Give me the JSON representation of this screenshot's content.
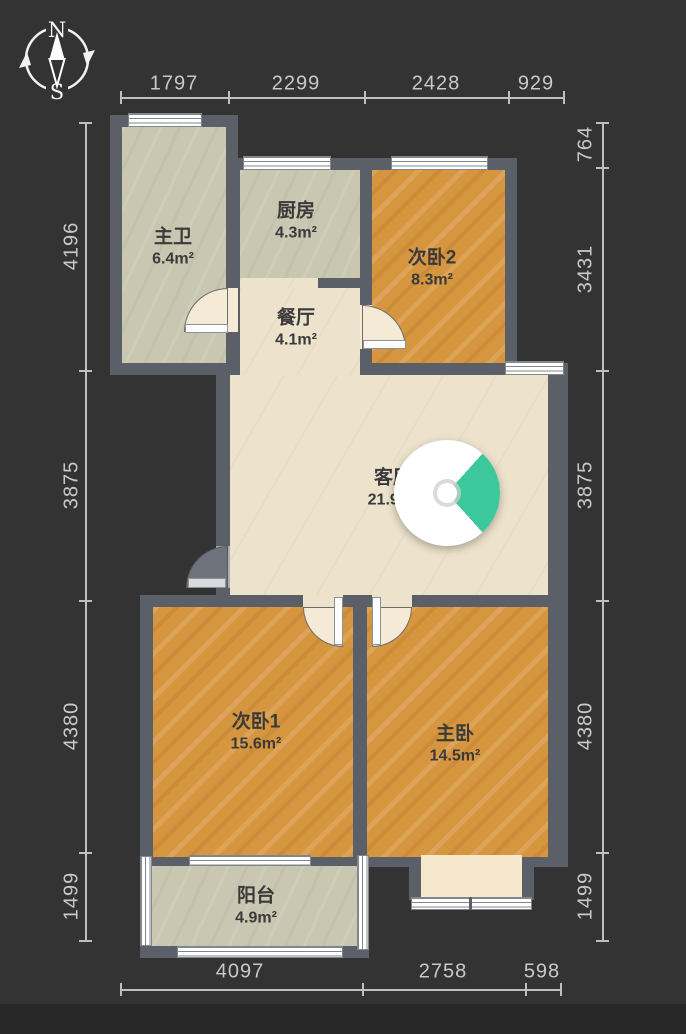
{
  "app": {
    "type": "floor-plan-viewer"
  },
  "compass": {
    "north_label": "N",
    "south_label": "S"
  },
  "rooms": [
    {
      "id": "master-bath",
      "name": "主卫",
      "area": "6.4m²"
    },
    {
      "id": "kitchen",
      "name": "厨房",
      "area": "4.3m²"
    },
    {
      "id": "dining",
      "name": "餐厅",
      "area": "4.1m²"
    },
    {
      "id": "bedroom2",
      "name": "次卧2",
      "area": "8.3m²"
    },
    {
      "id": "living",
      "name": "客厅",
      "area": "21.9m²"
    },
    {
      "id": "bedroom1",
      "name": "次卧1",
      "area": "15.6m²"
    },
    {
      "id": "master-bedroom",
      "name": "主卧",
      "area": "14.5m²"
    },
    {
      "id": "balcony",
      "name": "阳台",
      "area": "4.9m²"
    }
  ],
  "dimensions": {
    "top": [
      "1797",
      "2299",
      "2428",
      "929"
    ],
    "left": [
      "4196",
      "3875",
      "4380",
      "1499"
    ],
    "right": [
      "764",
      "3431",
      "3875",
      "4380",
      "1499"
    ],
    "bottom": [
      "4097",
      "2758",
      "598"
    ]
  },
  "colors": {
    "background": "#333334",
    "wall": "#5b5f67",
    "floor_marble": "#ede3cd",
    "floor_tile": "#c9c7b1",
    "floor_wood": "#d6953f",
    "viewpoint_accent": "#3dc89b",
    "dimension_text": "#c9c9c9",
    "label_text": "#3a3a3a"
  }
}
